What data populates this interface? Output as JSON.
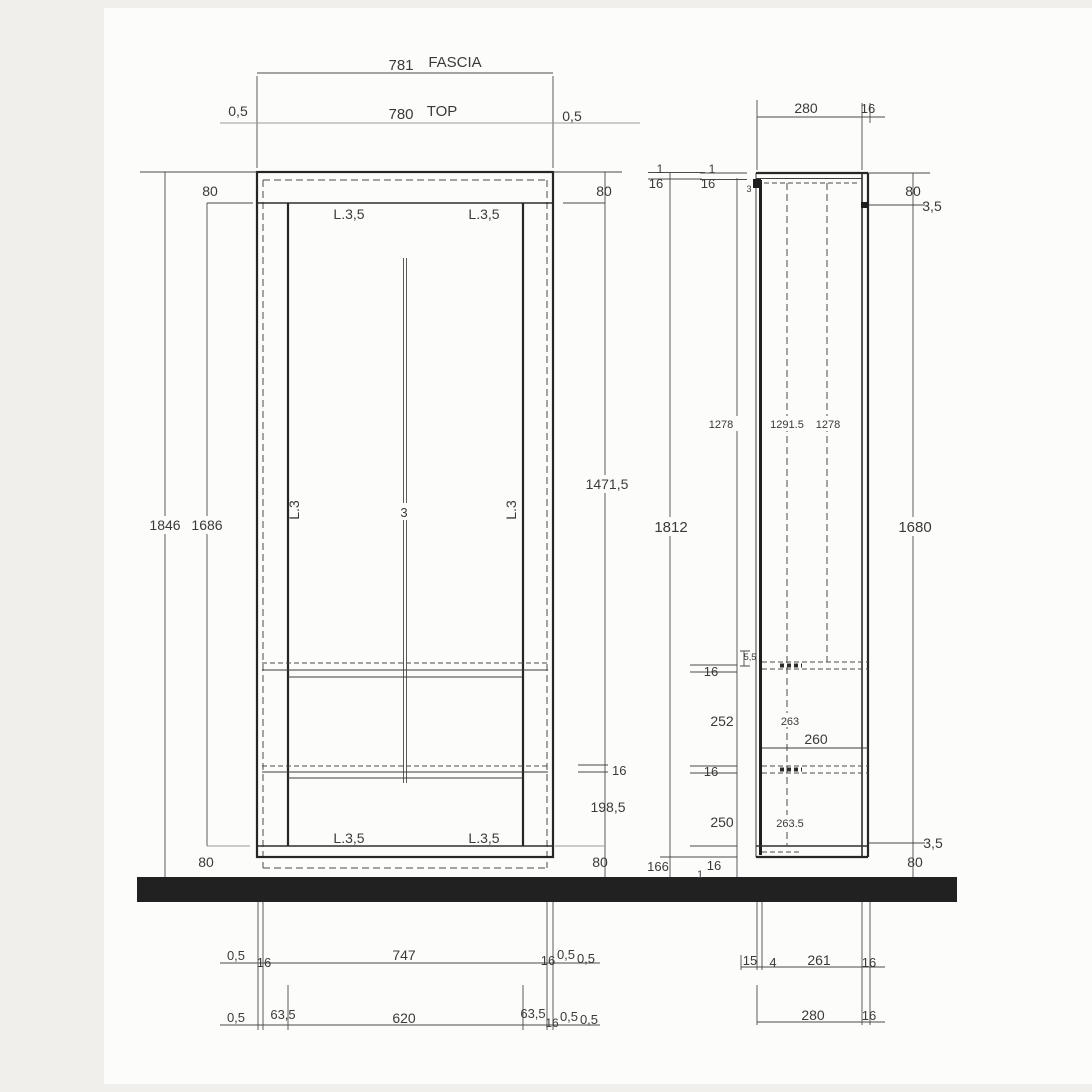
{
  "drawing": {
    "front": {
      "fascia_dim": "781",
      "fascia_label": "FASCIA",
      "top_offset_left": "0,5",
      "top_dim": "780",
      "top_label": "TOP",
      "top_offset_right": "0,5",
      "top_thickness_left": "80",
      "top_thickness_right": "80",
      "edge_top_left": "L.3,5",
      "edge_top_right": "L.3,5",
      "edge_side_left": "L.3",
      "edge_side_right": "L.3",
      "door_gap": "3",
      "height_total": "1846",
      "height_inner": "1686",
      "height_opening": "1471,5",
      "shelf_thickness": "16",
      "bottom_space": "198,5",
      "bottom_thickness_left": "80",
      "bottom_thickness_right": "80",
      "edge_bottom_left": "L.3,5",
      "edge_bottom_right": "L.3,5",
      "row1": {
        "a": "0,5",
        "b": "16",
        "c": "747",
        "d": "16",
        "e": "0,5",
        "f": "0,5"
      },
      "row2": {
        "a": "0,5",
        "b": "63,5",
        "c": "620",
        "d": "63,5",
        "e": "16",
        "f": "0,5",
        "g": "0,5"
      }
    },
    "side": {
      "depth_dim": "280",
      "back_thickness": "16",
      "gap_left": "1",
      "panel_left": "16",
      "gap_right": "1",
      "panel_right": "16",
      "edge_small": "3",
      "top_thickness": "80",
      "top_edge": "3,5",
      "inner_height_a": "1278",
      "inner_height_b": "1291.5",
      "inner_height_c": "1278",
      "height_total": "1812",
      "height_side": "1680",
      "shelf_recess": "5,5",
      "shelf1_thickness": "16",
      "space_a": "252",
      "space_a_inner": "263",
      "shelf_depth": "260",
      "shelf2_thickness": "16",
      "space_b": "250",
      "space_b_inner": "263.5",
      "bottom_edge": "3,5",
      "bottom_thickness": "80",
      "bottom_a": "166",
      "bottom_b": "16",
      "bottom_c": "1",
      "row1": {
        "a": "15",
        "b": "4",
        "c": "261",
        "d": "16"
      },
      "row2": {
        "a": "280",
        "b": "16"
      }
    }
  }
}
